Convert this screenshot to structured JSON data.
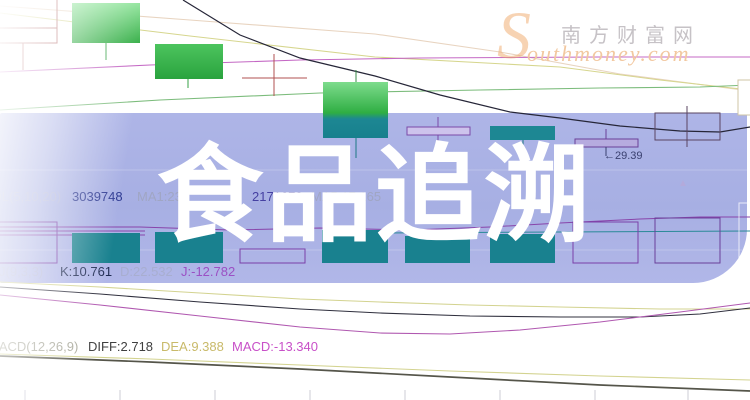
{
  "watermark": {
    "title": "食品追溯"
  },
  "logo": {
    "initial": "S",
    "site_name": "南方财富网",
    "domain_script": "outhmoney.com",
    "accent_color": "#f0a860"
  },
  "indicator_rows": {
    "volume": {
      "label": "VOL(5,10,20)",
      "volume_value": "3039748",
      "ma1": "MA1:23",
      "amount_value": "2171670",
      "ma5": "MA5:17,165"
    },
    "kdj": {
      "label": "KDJ(9,3,3)",
      "k": "K:10.761",
      "d": "D:22.532",
      "j": "J:-12.782"
    },
    "macd": {
      "label": "MACD(12,26,9)",
      "diff": "DIFF:2.718",
      "dea": "DEA:9.388",
      "macd": "MACD:-13.340"
    }
  },
  "annotations": {
    "price_label": "←29.39",
    "up_triangle": "▲"
  },
  "colors": {
    "band": "#a9b1e5",
    "candle_up_green": "#33ad45",
    "candle_teal": "#1d8793",
    "volume_bar_teal": "#19818f",
    "outline_purple": "#7a3fa8",
    "kdj_k_line": "#30303e",
    "kdj_d_line": "#d3d390",
    "kdj_j_line": "#b058b0",
    "macd_diff_line": "#55554a",
    "macd_dea_line": "#d3d390",
    "logo_orange": "#f2c8a0",
    "watermark_text": "#ffffff"
  },
  "chart_data": [
    {
      "type": "candlestick",
      "pane": "price",
      "annotations": [
        {
          "text": "29.39"
        }
      ]
    },
    {
      "type": "bar",
      "pane": "volume",
      "label": "VOL(5,10,20)",
      "values": {
        "volume": 3039748,
        "amount": 2171670,
        "ma1_partial": "23",
        "ma5_partial": "17,165"
      }
    },
    {
      "type": "line",
      "pane": "kdj",
      "label": "KDJ(9,3,3)",
      "values": {
        "K": 10.761,
        "D": 22.532,
        "J": -12.782
      }
    },
    {
      "type": "line",
      "pane": "macd",
      "label": "MACD(12,26,9)",
      "values": {
        "DIFF": 2.718,
        "DEA": 9.388,
        "MACD": -13.34
      }
    }
  ]
}
